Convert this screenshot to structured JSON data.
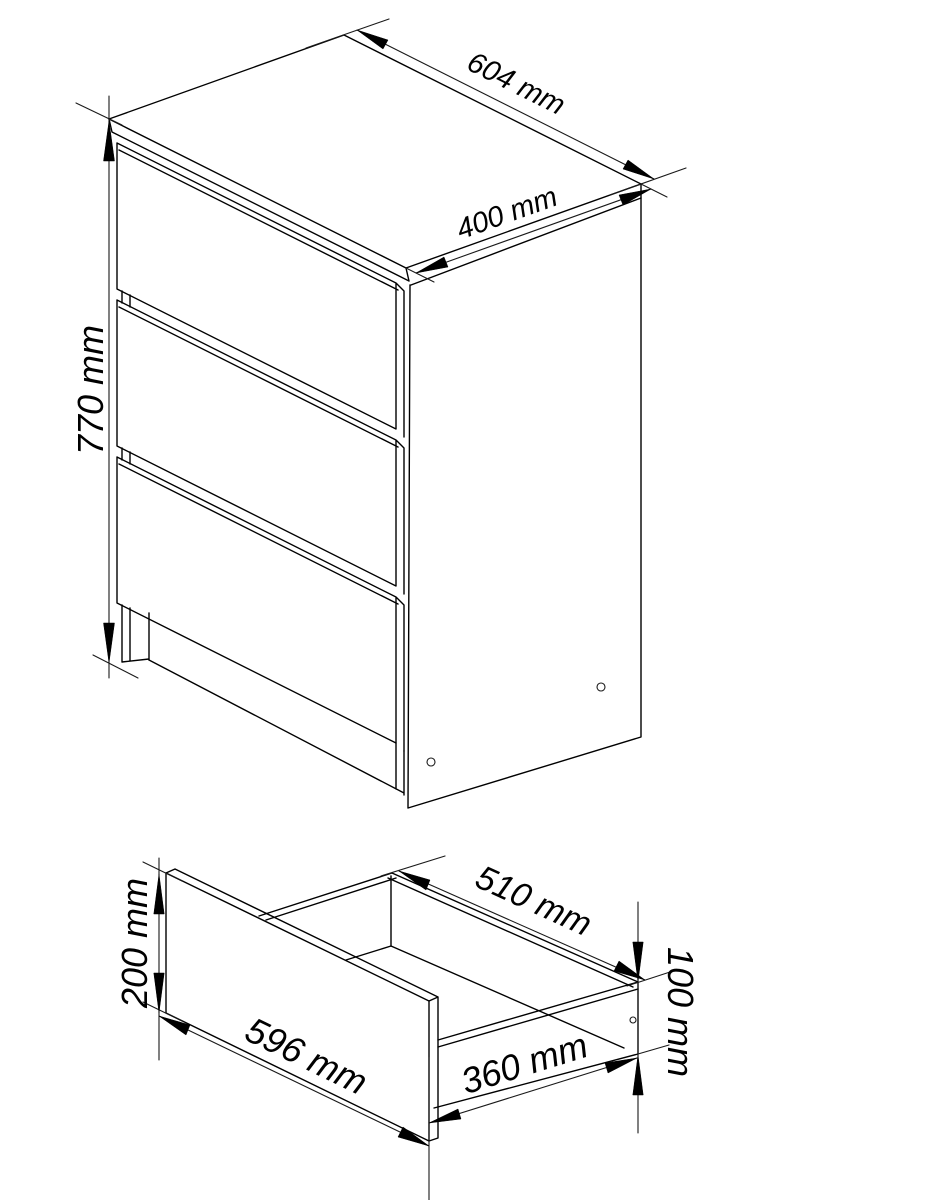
{
  "figure": {
    "kind": "furniture-dimension-drawing",
    "background": "#ffffff",
    "line_color": "#000000"
  },
  "cabinet_dims": {
    "height": "770 mm",
    "width": "604 mm",
    "depth": "400 mm"
  },
  "drawer_dims": {
    "front_height": "200 mm",
    "front_width": "596 mm",
    "inner_width": "510 mm",
    "depth": "360 mm",
    "side_height": "100 mm"
  }
}
